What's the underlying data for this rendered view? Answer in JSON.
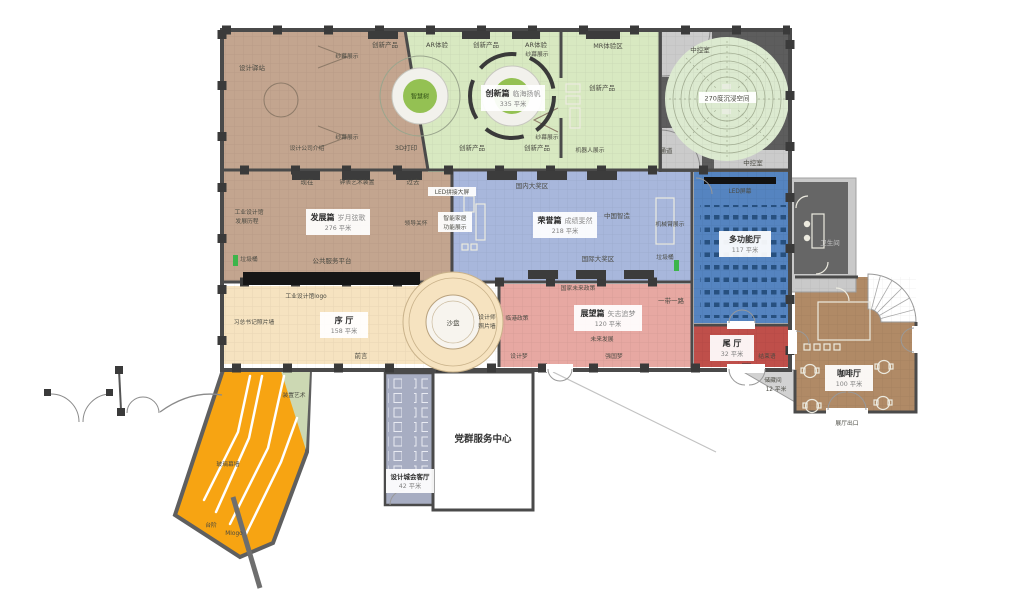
{
  "zones": {
    "development": {
      "name": "发展篇",
      "subtitle": "岁月弦歌",
      "area": "276 平米"
    },
    "innovation": {
      "name": "创新篇",
      "subtitle": "临海扬帆",
      "area": "335 平米"
    },
    "honor": {
      "name": "荣誉篇",
      "subtitle": "成绩斐然",
      "area": "218 平米"
    },
    "outlook": {
      "name": "展望篇",
      "subtitle": "矢志追梦",
      "area": "120 平米"
    },
    "foyer": {
      "name": "序 厅",
      "area": "158 平米"
    },
    "multifunction": {
      "name": "多功能厅",
      "area": "117 平米"
    },
    "tail": {
      "name": "尾 厅",
      "area": "32 平米"
    },
    "cafe": {
      "name": "咖啡厅",
      "area": "100 平米"
    },
    "reception": {
      "name": "设计城会客厅",
      "area": "42 平米"
    },
    "party_center": {
      "name": "党群服务中心"
    },
    "storage": {
      "name": "储藏间",
      "area": "12 平米"
    },
    "immersive": {
      "name": "270度沉浸空间"
    },
    "wisdom_tree": {
      "name": "智慧树"
    }
  },
  "labels": {
    "design_station": "设计驿站",
    "gauze_display": "纱幕展示",
    "innovative_product": "创新产品",
    "ar_experience": "AR体验",
    "mr_zone": "MR体验区",
    "control_room": "中控室",
    "passage": "通道",
    "design_company_intro": "设计公司介绍",
    "printing_3d": "3D打印",
    "robot_display": "机器人展示",
    "now": "现在",
    "clock_art": "钟表艺术装置",
    "past": "过去",
    "led_wall": "LED拼接大屏",
    "industrial_history_1": "工业设计馆",
    "industrial_history_2": "发展历程",
    "leader_care": "领导关怀",
    "smart_home_1": "智能家居",
    "smart_home_2": "功能展示",
    "trash_bin": "垃圾桶",
    "public_platform": "公共服务平台",
    "domestic_awards": "国内大奖区",
    "china_made": "中国智造",
    "robot_arm": "机械臂展示",
    "intl_awards": "国际大奖区",
    "national_policy": "国家未来政策",
    "led_screen": "LED屏幕",
    "restroom": "卫生间",
    "logo_wall": "工业设计馆logo",
    "photo_wall": "习总书记照片墙",
    "sand_table": "沙盘",
    "designer_wall_1": "设计师",
    "designer_wall_2": "照片墙",
    "foreword": "前言",
    "installation_art": "装置艺术",
    "belt_road": "一带一路",
    "lingang_policy": "临港政策",
    "future_dev": "未来发展",
    "design_dream": "设计梦",
    "power_dream": "强国梦",
    "closing": "结束语",
    "hall_exit": "展厅出口",
    "glass_wall": "玻璃幕墙",
    "steps": "台阶",
    "m_logo": "Mlogo"
  },
  "colors": {
    "development": "#c3a58f",
    "innovation": "#d8e9c1",
    "honor": "#a8b7dc",
    "multifunction": "#5584c0",
    "foyer": "#f6e3c0",
    "outlook": "#e7a8a2",
    "tail": "#bf4f4a",
    "cafe": "#b08a66",
    "reception": "#a7adc2",
    "ramp": "#f7a412",
    "install_green": "#ccd8b3",
    "immersive": "#dcead0"
  }
}
